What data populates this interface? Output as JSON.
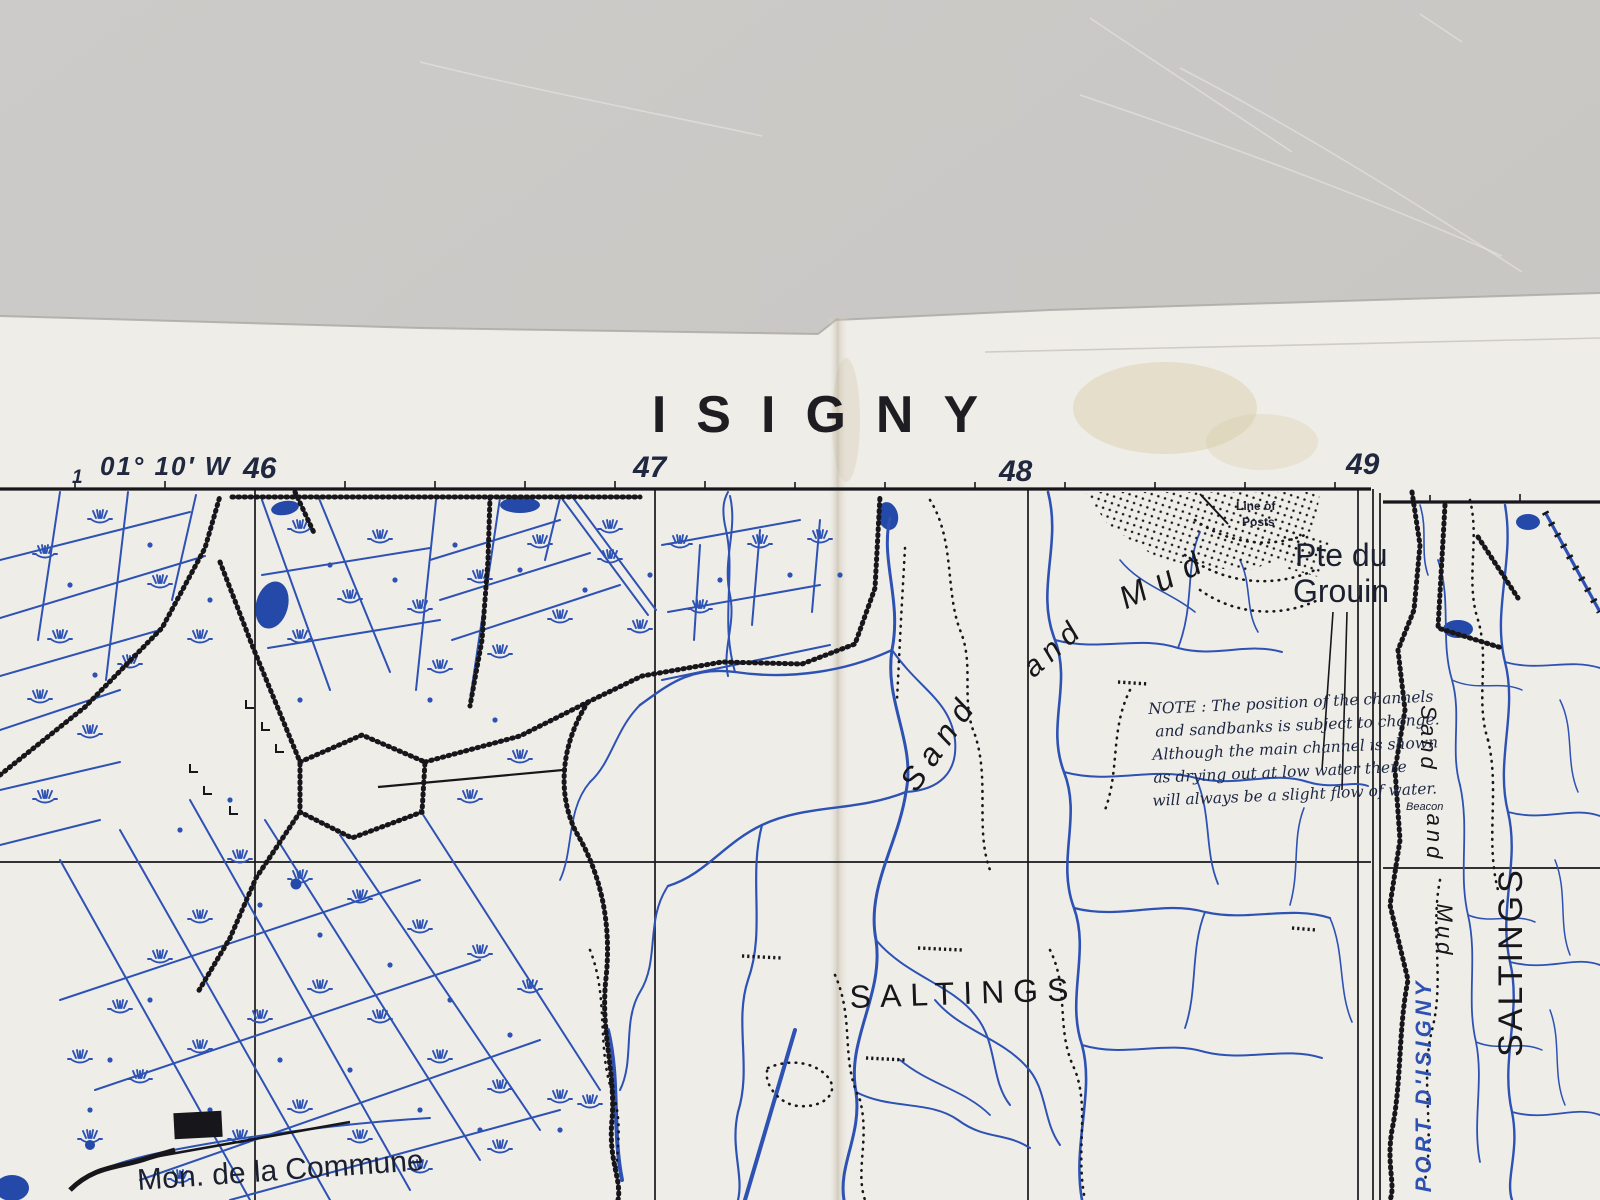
{
  "scene": {
    "description": "Photograph of a WWII-era printed map sheet lying on a grey surface",
    "colors": {
      "background_color": "#c9c7c4",
      "paper_color": "#efede8",
      "ink_color": "#17171b",
      "blue_color": "#2d52b4",
      "stain_color": "#d6cba6"
    }
  },
  "map": {
    "title": "ISIGNY",
    "margin": {
      "tick_label": "1",
      "coordinate_label": "01° 10′ W",
      "grid_numbers": [
        "46",
        "47",
        "48",
        "49"
      ]
    },
    "labels": {
      "line_of_posts_1": "Line of",
      "line_of_posts_2": "Posts",
      "pte_du_grouin_1": "Pte du",
      "pte_du_grouin_2": "Grouin",
      "estuary_word_1": "Sand",
      "estuary_word_2": "and",
      "estuary_word_3": "Mud",
      "saltings": "SALTINGS",
      "mon_de_la_commune": "Mon. de la Commune",
      "beacon": "Beacon",
      "right_margin_word_1": "Sand",
      "right_margin_word_2": "and",
      "right_margin_word_3": "Mud",
      "right_saltings": "SALTINGS",
      "adjoining_sheet_name": "PORT D'ISIGNY"
    },
    "note": {
      "lines": [
        "NOTE : The position of the channels",
        "and sandbanks is  subject to change.",
        "Although the main channel is shown",
        "as drying out at  low water there",
        "will always be a slight flow of water."
      ]
    }
  }
}
